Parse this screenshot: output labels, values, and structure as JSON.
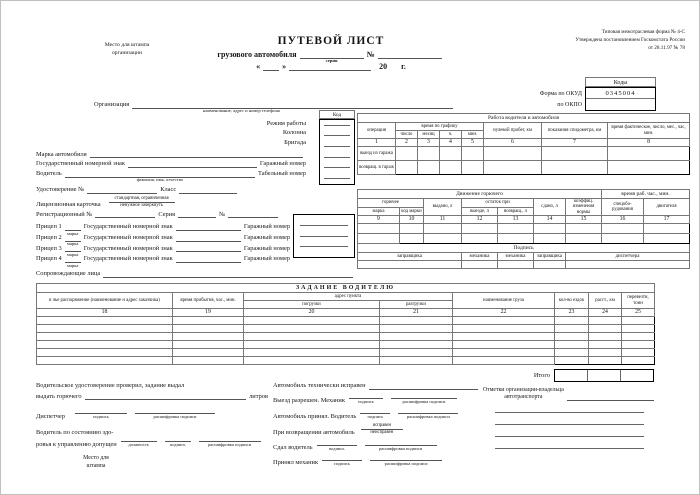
{
  "header": {
    "stamp_line1": "Место для штампа",
    "stamp_line2": "организации",
    "title": "ПУТЕВОЙ ЛИСТ",
    "subtitle": "грузового автомобиля",
    "series_label": "серия",
    "number_sign": "№",
    "quote_open": "«",
    "quote_close": "»",
    "year_prefix": "20",
    "year_suffix": "г.",
    "form_line1": "Типовая межотраслевая форма № 4-С",
    "form_line2": "Утверждена постановлением Госкомстата России",
    "form_line3": "от 28.11.97 № 78",
    "codes_title": "Коды",
    "okud_label": "Форма по ОКУД",
    "okud_value": "0345004",
    "okpo_label": "по ОКПО"
  },
  "info": {
    "org_label": "Организация",
    "org_sub": "наименование, адрес и номер телефона",
    "code_col_title": "Код",
    "work_mode": "Режим работы",
    "column": "Колонна",
    "brigade": "Бригада",
    "vehicle_make": "Марка автомобиля",
    "state_plate": "Государственный номерной знак",
    "garage_number": "Гаражный номер",
    "driver": "Водитель",
    "driver_sub": "фамилия, имя, отчество",
    "personnel_number": "Табельный номер",
    "license_no": "Удостоверение №",
    "class_label": "Класс",
    "license_card": "Лицензионная карточка",
    "license_card_sub1": "стандартная, ограниченная",
    "license_card_sub2": "ненужное зачеркнуть",
    "registration_no": "Регистрационный №",
    "series": "Серия",
    "number_sign": "№",
    "trailers": [
      "Прицеп 1",
      "Прицеп 2",
      "Прицеп 3",
      "Прицеп 4"
    ],
    "trailer_make_sub": "марка",
    "escorts": "Сопровождающие лица"
  },
  "work_table": {
    "title": "Работа водителя и автомобиля",
    "operation": "операция",
    "schedule_group": "время по графику",
    "schedule_cols": [
      "число",
      "месяц",
      "ч.",
      "мин."
    ],
    "zero_run": "нулевой пробег, км",
    "speedometer": "показания спидометра, км",
    "actual_time": "время фактическое, число, мес., час, мин.",
    "numbers": [
      "1",
      "2",
      "3",
      "4",
      "5",
      "6",
      "7",
      "8"
    ],
    "row_labels": [
      "выезд из гаража",
      "возвращ. в гараж"
    ]
  },
  "fuel_table": {
    "title": "Движение горючего",
    "fuel_group": "горючее",
    "make": "марка",
    "make_code": "код марки",
    "issued": "выдано, л",
    "remainder_group": "остаток при",
    "on_departure": "выезде, л",
    "on_return": "возвращ., л",
    "handed_in": "сдано, л",
    "coefficient": "коэффиц. изменения нормы",
    "time_group": "время раб. час., мин.",
    "special_equipment": "спецобо-рудования",
    "engine": "двигателя",
    "numbers": [
      "9",
      "10",
      "11",
      "12",
      "13",
      "14",
      "15",
      "16",
      "17"
    ],
    "signature_title": "Подпись",
    "signature_cols": [
      "заправщика",
      "механика",
      "механика",
      "заправщика",
      "диспетчера"
    ]
  },
  "task_table": {
    "title": "ЗАДАНИЕ ВОДИТЕЛЮ",
    "disposal": "в чье распоряжение (наименование и адрес заказчика)",
    "arrival_time": "время прибытия, час., мин.",
    "address_group": "адрес пункта",
    "loading": "погрузки",
    "unloading": "разгрузки",
    "cargo_name": "наименование груза",
    "trips": "кол-во ездок",
    "distance": "расст., км",
    "transport": "перевезти, тонн",
    "numbers": [
      "18",
      "19",
      "20",
      "21",
      "22",
      "23",
      "24",
      "25"
    ],
    "total_label": "Итого"
  },
  "footer": {
    "license_checked": "Водительское удостоверение проверил, задание выдал",
    "issue_fuel": "выдать горючего",
    "liters": "литров",
    "dispatcher": "Диспетчер",
    "sign_sub": "подпись",
    "sign_decode_sub": "расшифровка подписи",
    "health_line1": "Водитель по состоянию здо-",
    "health_line2": "ровья к управлению допущен",
    "position_sub": "должность",
    "stamp_line1": "Место для",
    "stamp_line2": "штампа",
    "tech_ok": "Автомобиль технически исправен",
    "departure_allowed": "Выезд разрешен. Механик",
    "vehicle_accepted": "Автомобиль принял. Водитель",
    "on_return_vehicle": "При возвращении автомобиль",
    "serviceable": "исправен",
    "unserviceable": "неисправен",
    "handed_by_driver": "Сдал водитель",
    "accepted_by_mechanic": "Принял механик",
    "owner_marks_line1": "Отметки организации-владельца",
    "owner_marks_line2": "автотранспорта"
  }
}
